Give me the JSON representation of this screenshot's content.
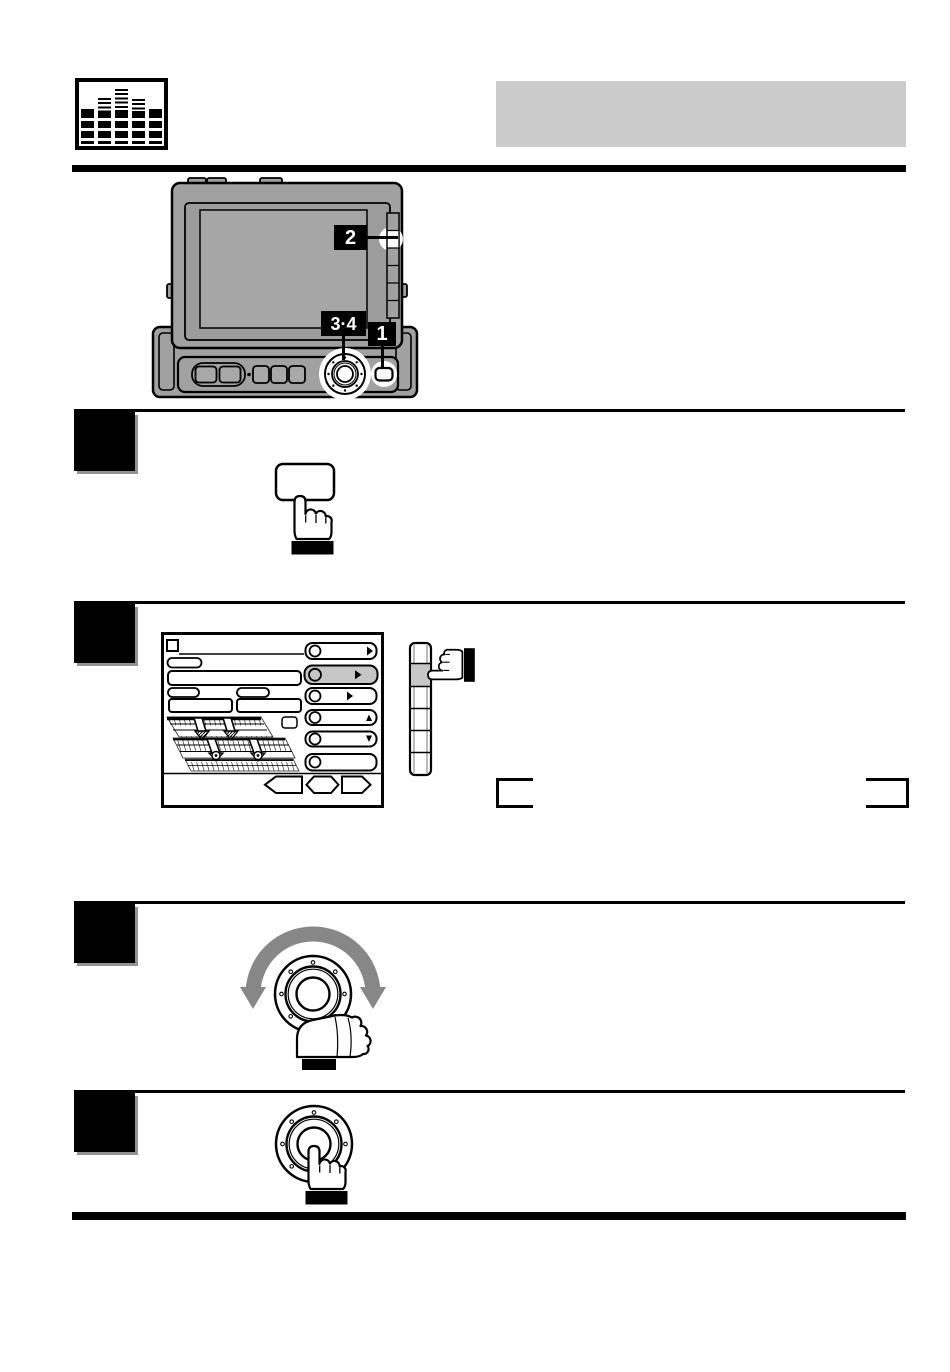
{
  "header": {
    "icon": "equalizer-levels-icon",
    "banner_title": ""
  },
  "device_illustration": {
    "name": "flip-screen-head-unit",
    "callouts": [
      {
        "label": "2",
        "target": "screen-side-button"
      },
      {
        "label": "3·4",
        "target": "rotary-encoder-knob"
      },
      {
        "label": "1",
        "target": "button-right-of-knob"
      }
    ]
  },
  "steps": [
    {
      "illustration": "press-key-with-finger"
    },
    {
      "illustration": "eq-adjust-screen-and-side-button-press"
    },
    {
      "illustration": "rotate-knob-both-directions"
    },
    {
      "illustration": "press-knob-center"
    }
  ],
  "colors": {
    "banner_gray": "#cbcbcb",
    "device_body_gray": "#a1a1a1",
    "pressed_button_gray": "#c6c6c6",
    "rotation_arrow_gray": "#878787",
    "ink": "#000000"
  }
}
